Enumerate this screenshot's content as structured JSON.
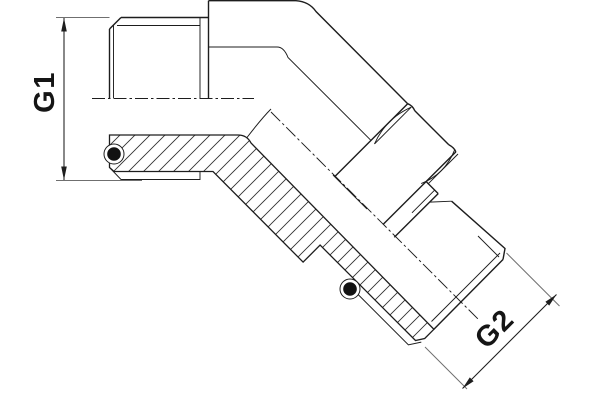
{
  "drawing": {
    "labels": {
      "g1": "G1",
      "g2": "G2"
    },
    "colors": {
      "background": "#ffffff",
      "line": "#1d1d1d",
      "extension_line": "#6f6f6f",
      "o_ring": "#121212"
    }
  }
}
